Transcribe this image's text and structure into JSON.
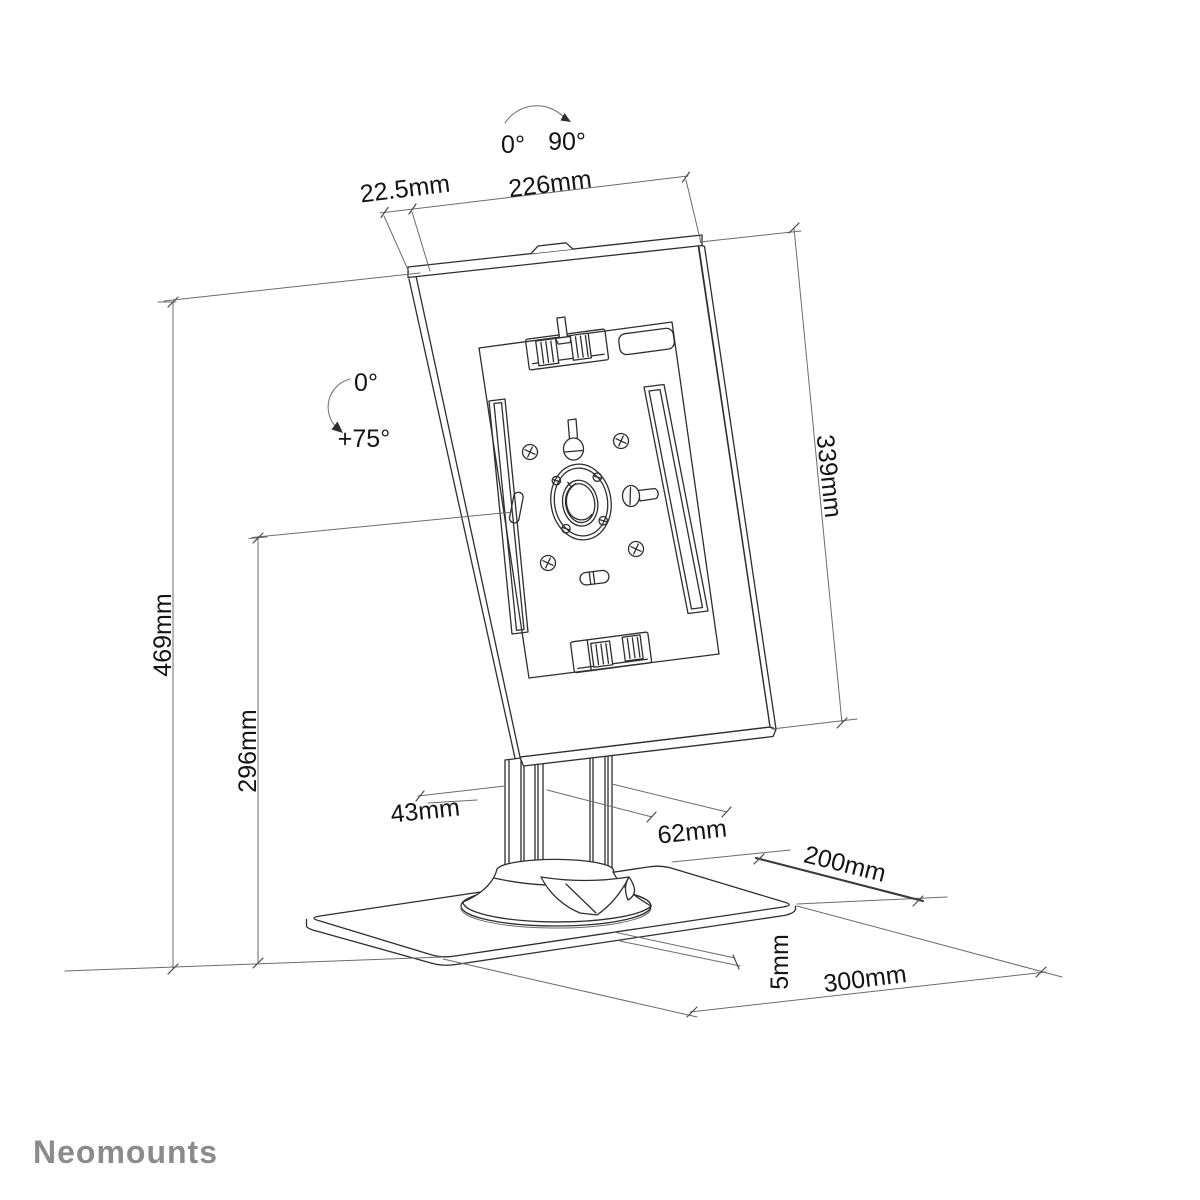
{
  "brand": "Neomounts",
  "annotations": {
    "rotation_range": {
      "from": "0°",
      "to": "90°"
    },
    "tilt_range": {
      "from": "0°",
      "to": "+75°"
    }
  },
  "dimensions": {
    "enclosure_side_offset": "22.5mm",
    "enclosure_width": "226mm",
    "enclosure_height": "339mm",
    "total_height": "469mm",
    "pivot_height": "296mm",
    "pole_depth": "43mm",
    "pole_width": "62mm",
    "base_depth": "200mm",
    "base_thickness": "5mm",
    "base_width": "300mm"
  },
  "colors": {
    "line": "#2e2e2e",
    "dimension_line": "#6b6b6b",
    "logo": "#8b8b8b"
  }
}
